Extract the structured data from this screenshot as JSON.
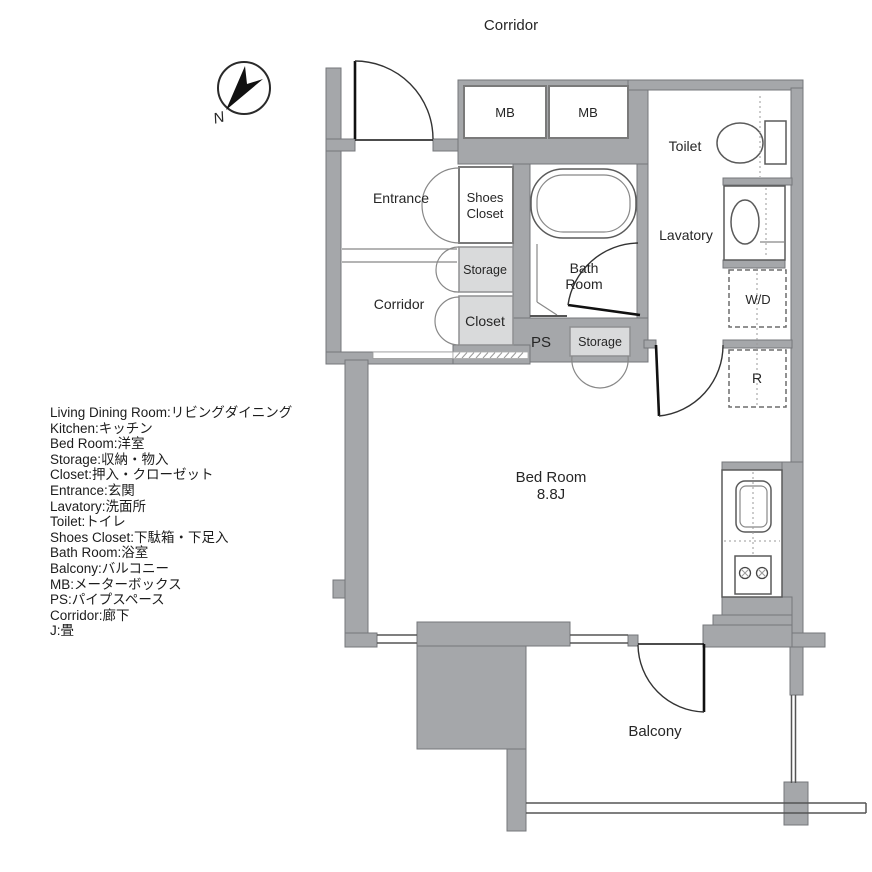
{
  "header": {
    "outside_corridor": "Corridor"
  },
  "compass": {
    "label": "N"
  },
  "rooms": {
    "entrance": "Entrance",
    "shoes_closet_line1": "Shoes",
    "shoes_closet_line2": "Closet",
    "storage_upper": "Storage",
    "corridor_inner": "Corridor",
    "closet": "Closet",
    "mb1": "MB",
    "mb2": "MB",
    "toilet": "Toilet",
    "lavatory": "Lavatory",
    "bath_line1": "Bath",
    "bath_line2": "Room",
    "wd": "W/D",
    "ps": "PS",
    "storage_lower": "Storage",
    "refrigerator": "R",
    "bedroom_line1": "Bed Room",
    "bedroom_size": "8.8J",
    "balcony": "Balcony"
  },
  "legend": {
    "lines": [
      "Living Dining Room:リビングダイニング",
      "Kitchen:キッチン",
      "Bed Room:洋室",
      "Storage:収納・物入",
      "Closet:押入・クローゼット",
      "Entrance:玄関",
      "Lavatory:洗面所",
      "Toilet:トイレ",
      "Shoes Closet:下駄箱・下足入",
      "Bath Room:浴室",
      "Balcony:バルコニー",
      "MB:メーターボックス",
      "PS:パイプスペース",
      "Corridor:廊下",
      "J:畳"
    ]
  },
  "colors": {
    "wall": "#a5a7aa",
    "wall_outline": "#75777b",
    "light_box": "#d9dadb",
    "line": "#333333",
    "text": "#262626",
    "background": "#ffffff"
  }
}
